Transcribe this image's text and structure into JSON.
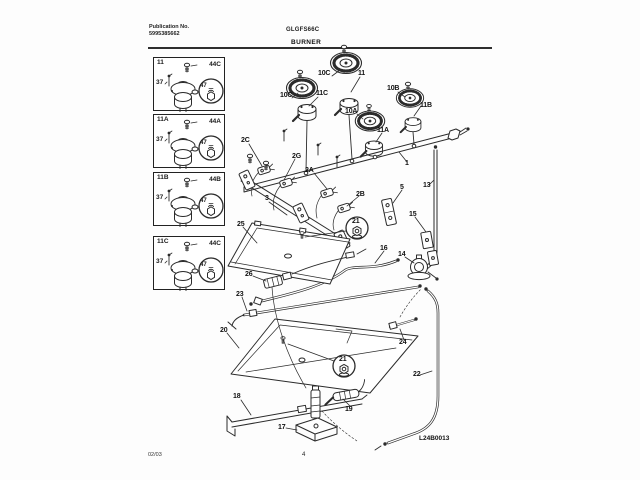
{
  "header": {
    "publication_label": "Publication No.",
    "publication_number": "5995385662",
    "model": "GLGFS66C",
    "section_title": "BURNER"
  },
  "callout_boxes": [
    {
      "id": "11",
      "screw": "44C",
      "pin": "37",
      "orifice": "47"
    },
    {
      "id": "11A",
      "screw": "44A",
      "pin": "37",
      "orifice": "47"
    },
    {
      "id": "11B",
      "screw": "44B",
      "pin": "37",
      "orifice": "47"
    },
    {
      "id": "11C",
      "screw": "44C",
      "pin": "37",
      "orifice": "47"
    }
  ],
  "diagram_labels": [
    {
      "t": "10C",
      "x": 318,
      "y": 70
    },
    {
      "t": "11",
      "x": 358,
      "y": 70
    },
    {
      "t": "10C",
      "x": 280,
      "y": 92
    },
    {
      "t": "11C",
      "x": 316,
      "y": 90
    },
    {
      "t": "10B",
      "x": 387,
      "y": 85
    },
    {
      "t": "11B",
      "x": 420,
      "y": 102
    },
    {
      "t": "10A",
      "x": 345,
      "y": 108
    },
    {
      "t": "11A",
      "x": 377,
      "y": 127
    },
    {
      "t": "2C",
      "x": 241,
      "y": 137
    },
    {
      "t": "2G",
      "x": 292,
      "y": 153
    },
    {
      "t": "2A",
      "x": 305,
      "y": 167
    },
    {
      "t": "2B",
      "x": 356,
      "y": 191
    },
    {
      "t": "3",
      "x": 265,
      "y": 195
    },
    {
      "t": "1",
      "x": 405,
      "y": 160
    },
    {
      "t": "13",
      "x": 423,
      "y": 182
    },
    {
      "t": "5",
      "x": 400,
      "y": 184
    },
    {
      "t": "15",
      "x": 409,
      "y": 211
    },
    {
      "t": "21",
      "x": 357,
      "y": 228,
      "circled": true
    },
    {
      "t": "16",
      "x": 380,
      "y": 245
    },
    {
      "t": "14",
      "x": 398,
      "y": 251
    },
    {
      "t": "25",
      "x": 237,
      "y": 221
    },
    {
      "t": "26",
      "x": 245,
      "y": 271
    },
    {
      "t": "23",
      "x": 236,
      "y": 291
    },
    {
      "t": "20",
      "x": 220,
      "y": 327
    },
    {
      "t": "24",
      "x": 399,
      "y": 339
    },
    {
      "t": "22",
      "x": 413,
      "y": 371
    },
    {
      "t": "21",
      "x": 344,
      "y": 366,
      "circled": true
    },
    {
      "t": "18",
      "x": 233,
      "y": 393
    },
    {
      "t": "19",
      "x": 345,
      "y": 406
    },
    {
      "t": "17",
      "x": 278,
      "y": 424
    }
  ],
  "footer": {
    "date_code": "02/03",
    "page_number": "4",
    "diagram_code": "L24B0013"
  }
}
